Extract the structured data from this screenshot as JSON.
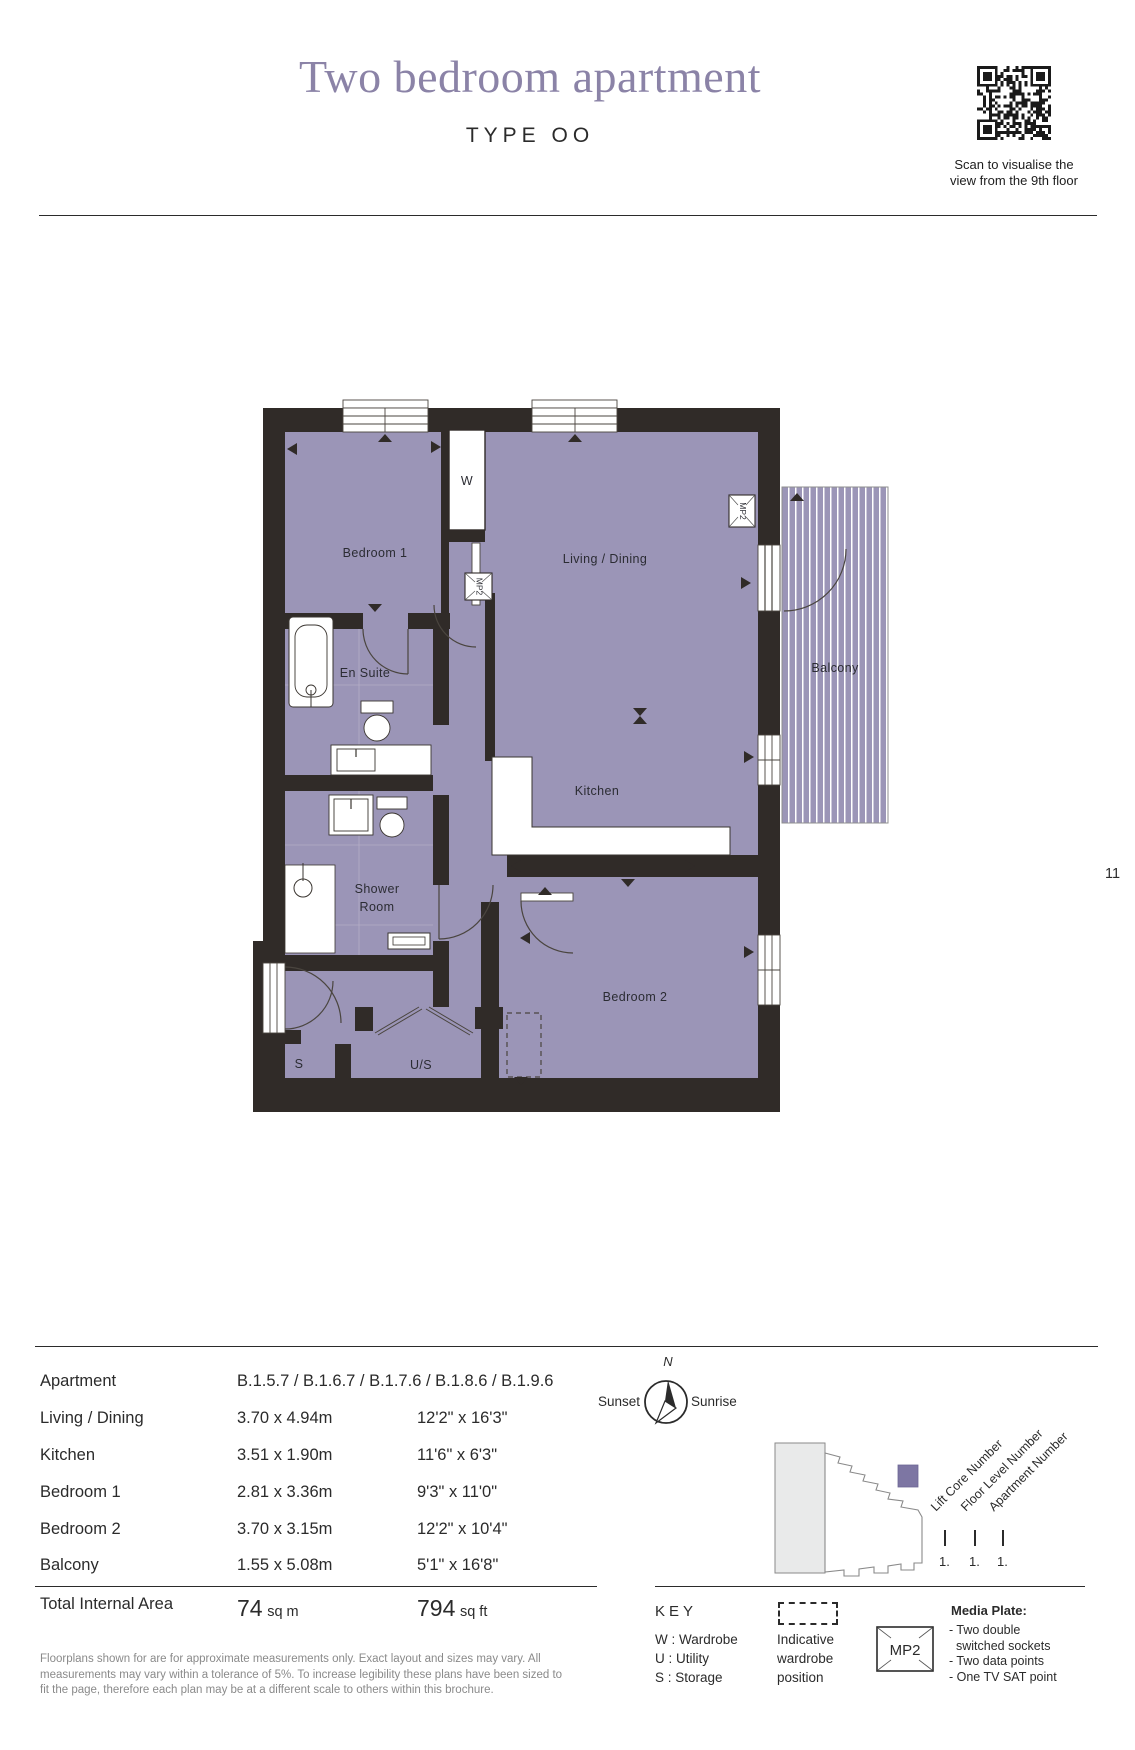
{
  "header": {
    "title": "Two bedroom apartment",
    "subtitle": "TYPE OO",
    "qr_caption_line1": "Scan to visualise the",
    "qr_caption_line2": "view from the 9th floor"
  },
  "page_number": "11",
  "floorplan": {
    "labels": {
      "bedroom1": "Bedroom 1",
      "wardrobe": "W",
      "living_dining": "Living / Dining",
      "en_suite": "En Suite",
      "kitchen": "Kitchen",
      "shower_line1": "Shower",
      "shower_line2": "Room",
      "bedroom2": "Bedroom 2",
      "balcony": "Balcony",
      "storage": "S",
      "utility_storage": "U/S",
      "media_plate": "MP2"
    }
  },
  "dimensions_table": {
    "rows": [
      {
        "label": "Apartment",
        "metric": "B.1.5.7 / B.1.6.7 / B.1.7.6 / B.1.8.6 / B.1.9.6",
        "imperial": ""
      },
      {
        "label": "Living / Dining",
        "metric": "3.70 x 4.94m",
        "imperial": "12'2\" x 16'3\""
      },
      {
        "label": "Kitchen",
        "metric": "3.51 x 1.90m",
        "imperial": "11'6\" x 6'3\""
      },
      {
        "label": "Bedroom 1",
        "metric": "2.81 x 3.36m",
        "imperial": "9'3\" x 11'0\""
      },
      {
        "label": "Bedroom 2",
        "metric": "3.70 x 3.15m",
        "imperial": "12'2\" x 10'4\""
      },
      {
        "label": "Balcony",
        "metric": "1.55 x 5.08m",
        "imperial": "5'1\" x 16'8\""
      }
    ],
    "total": {
      "label": "Total Internal Area",
      "metric_value": "74",
      "metric_unit": "sq m",
      "imperial_value": "794",
      "imperial_unit": "sq ft"
    }
  },
  "disclaimer": {
    "line1": "Floorplans shown for are for approximate measurements only. Exact layout and sizes may vary. All",
    "line2": "measurements may vary within a tolerance of 5%. To increase legibility these plans have been sized to",
    "line3": "fit the page, therefore each plan may be at a different scale to others within this brochure."
  },
  "compass": {
    "north_label": "N",
    "west_label": "Sunset",
    "east_label": "Sunrise"
  },
  "locator": {
    "labels": [
      "Lift Core Number",
      "Floor Level Number",
      "Apartment Number"
    ],
    "values": [
      "1.",
      "1.",
      "1."
    ]
  },
  "key": {
    "heading": "KEY",
    "items": [
      "W : Wardrobe",
      "U : Utility",
      "S : Storage"
    ],
    "wardrobe_note_line1": "Indicative",
    "wardrobe_note_line2": "wardrobe",
    "wardrobe_note_line3": "position",
    "media_plate_box": "MP2",
    "media_plate_title": "Media Plate:",
    "media_plate_lines": [
      "- Two double",
      "switched sockets",
      "- Two data points",
      "- One TV SAT point"
    ]
  },
  "colors": {
    "title_purple": "#8b83a7",
    "room_purple": "#9b95b7",
    "wall_dark": "#302b28",
    "text_dark": "#2b2b2b",
    "muted_gray": "#8a8a8a",
    "locator_highlight": "#7d76a3"
  }
}
